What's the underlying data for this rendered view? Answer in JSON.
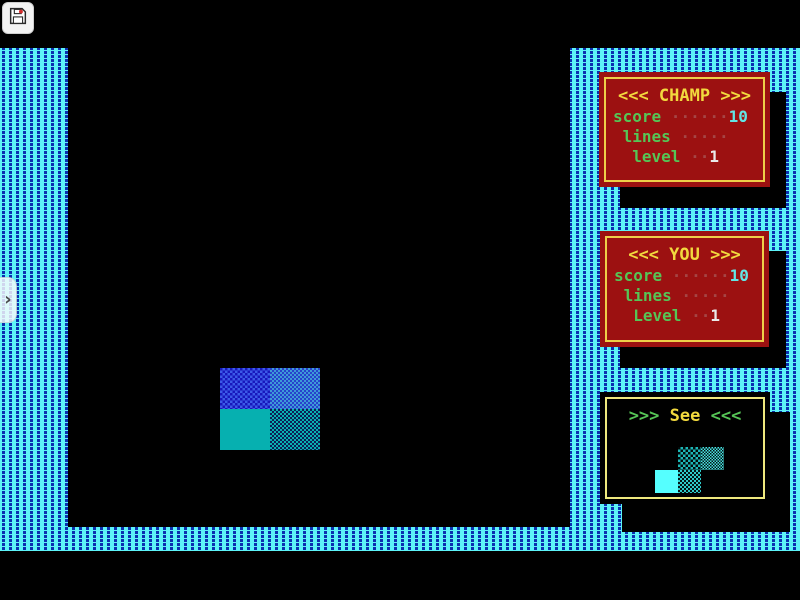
{
  "app": {
    "save_button": {
      "icon": "floppy-disk-icon"
    },
    "drawer_handle": {
      "chevron": "›"
    }
  },
  "champ_panel": {
    "title": "<<< CHAMP >>>",
    "rows": [
      {
        "label": "score",
        "dots": " ······",
        "value": "10"
      },
      {
        "label": " lines",
        "dots": " ·····",
        "value": ""
      },
      {
        "label": "  level",
        "dots": " ··",
        "value": "1"
      }
    ]
  },
  "you_panel": {
    "title": "<<< YOU >>>",
    "rows": [
      {
        "label": "score",
        "dots": " ······",
        "value": "10"
      },
      {
        "label": " lines",
        "dots": " ·····",
        "value": ""
      },
      {
        "label": "  Level",
        "dots": " ··",
        "value": "1"
      }
    ]
  },
  "see_panel": {
    "arrows_left": ">>> ",
    "title": "See",
    "arrows_right": " <<<",
    "next_piece_shape": "S-piece"
  },
  "falling_piece": {
    "shape": "O-piece"
  },
  "colors": {
    "border_cyan": "#5df2f7",
    "border_dash_blue": "#0b2fb0",
    "panel_red": "#9c1111",
    "panel_border_yellow": "#eecf49",
    "see_border_yellow": "#efe97e",
    "label_green": "#56c556",
    "title_yellow": "#f2d93e",
    "dots_red": "#a54545",
    "score_value_cyan": "#62e6e6",
    "level_value_white": "#eaeaea",
    "piece_teal": "#06b0b0",
    "piece_blue": "#1818bc",
    "next_piece_cyan": "#55ffff"
  }
}
